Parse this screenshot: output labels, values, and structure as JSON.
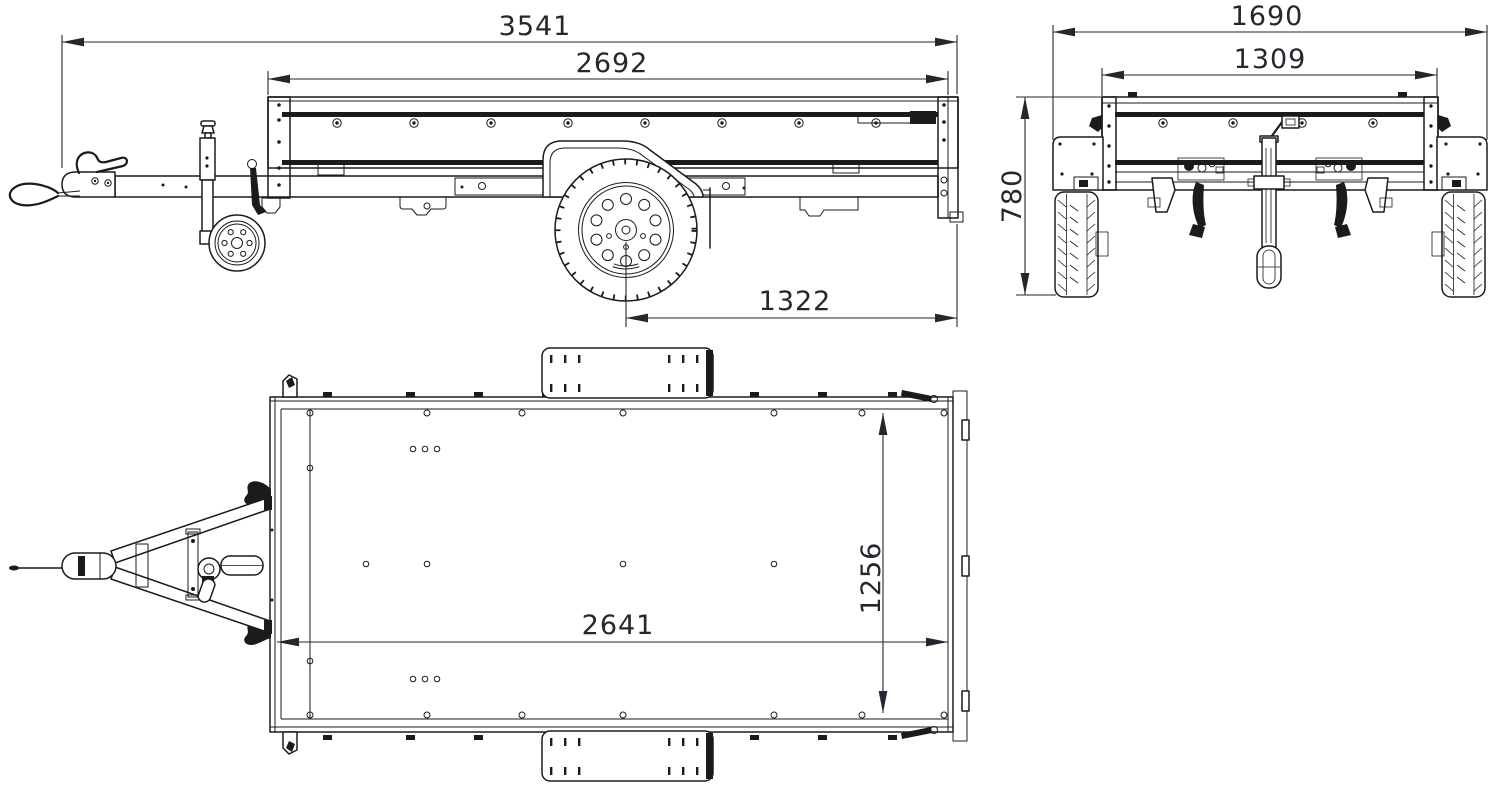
{
  "drawing": {
    "background_color": "#ffffff",
    "line_color": "#1b1b1d",
    "dimension_color": "#26262e",
    "views": {
      "side": {
        "name": "side-view",
        "dimensions": {
          "overall_length": "3541",
          "box_length": "2692",
          "axle_to_rear": "1322"
        }
      },
      "rear": {
        "name": "rear-view",
        "dimensions": {
          "overall_width": "1690",
          "box_width": "1309",
          "overall_height": "780"
        }
      },
      "top": {
        "name": "top-view",
        "dimensions": {
          "inner_length": "2641",
          "inner_width": "1256"
        }
      }
    }
  }
}
